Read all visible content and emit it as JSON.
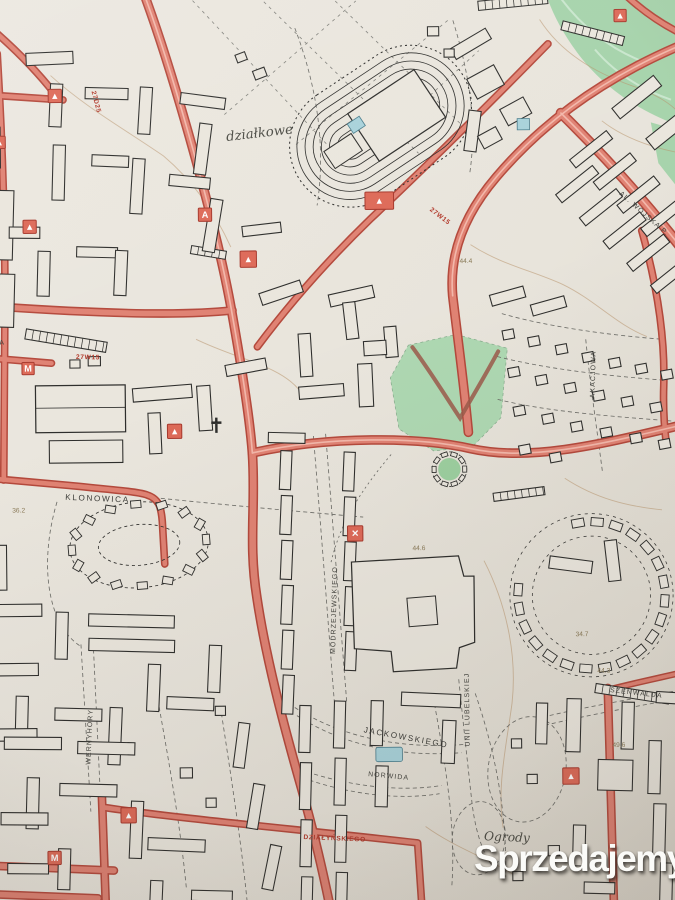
{
  "map_labels": {
    "dzialkowe": "działkowe",
    "al_wojska": "AL. WOJSKA P.",
    "klonowica": "KLONOWICA",
    "modrzejewskiego": "MODRZEJEWSKIEGO",
    "jackowskiego": "JACKOWSKIEGO",
    "norwida": "NORWIDA",
    "unii_lubelskiej": "UNII LUBELSKIEJ",
    "wernyhory": "WERNYHORY",
    "szenwalda": "SZENWALDA",
    "akacjowa": "AKACJOWA",
    "ogrody": "Ogrody",
    "dzialynskiego": "DZIAŁYŃSKIEGO",
    "partial_za": "ZA"
  },
  "elevations": [
    "36.2",
    "44.4",
    "44.6",
    "34.7",
    "44.3",
    "49.6"
  ],
  "route_markers": [
    "27D25",
    "27W15",
    "27W15"
  ],
  "poi_glyphs": {
    "triangle": "▲",
    "letter_m": "M",
    "letter_a": "A",
    "cross": "✕"
  },
  "watermark": {
    "brand": "Sprzedajemy",
    "tld": ".pl"
  },
  "colors": {
    "paper": "#eae6dd",
    "road_fill": "#e08273",
    "road_edge": "#b4493c",
    "green_area": "#a6d3ab",
    "water": "#a8d2da",
    "building_line": "#2e2e2c",
    "contour": "#b8936b",
    "watermark_red": "#e23b2e"
  }
}
